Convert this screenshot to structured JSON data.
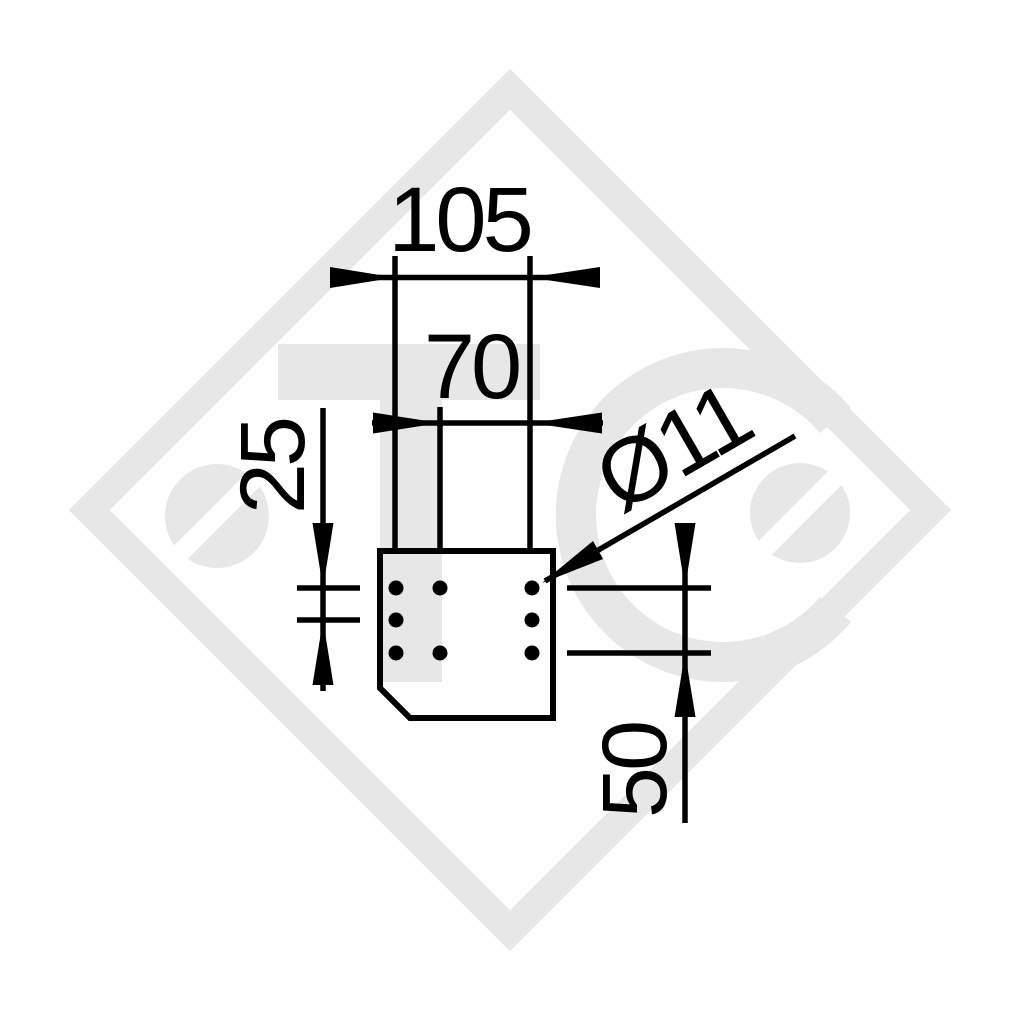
{
  "title": "Technical dimension drawing of bolt-on mounting plate",
  "colors": {
    "line": "#000000",
    "watermark": "#e7e7e7",
    "background": "#ffffff"
  },
  "dims": {
    "outer_width": "105",
    "inner_width": "70",
    "row_pitch": "25",
    "row_span": "50",
    "hole_diameter": "Ø11"
  },
  "part": {
    "description": "flat plate with chamfered bottom-left corner",
    "hole_count": 8,
    "hole_pattern": "3 left column + 2 middle column + 3 right column"
  },
  "watermark": {
    "letters": "TC",
    "icons": [
      "slotted-screw-head-left",
      "slotted-screw-head-right"
    ],
    "border": "diamond-outline"
  }
}
